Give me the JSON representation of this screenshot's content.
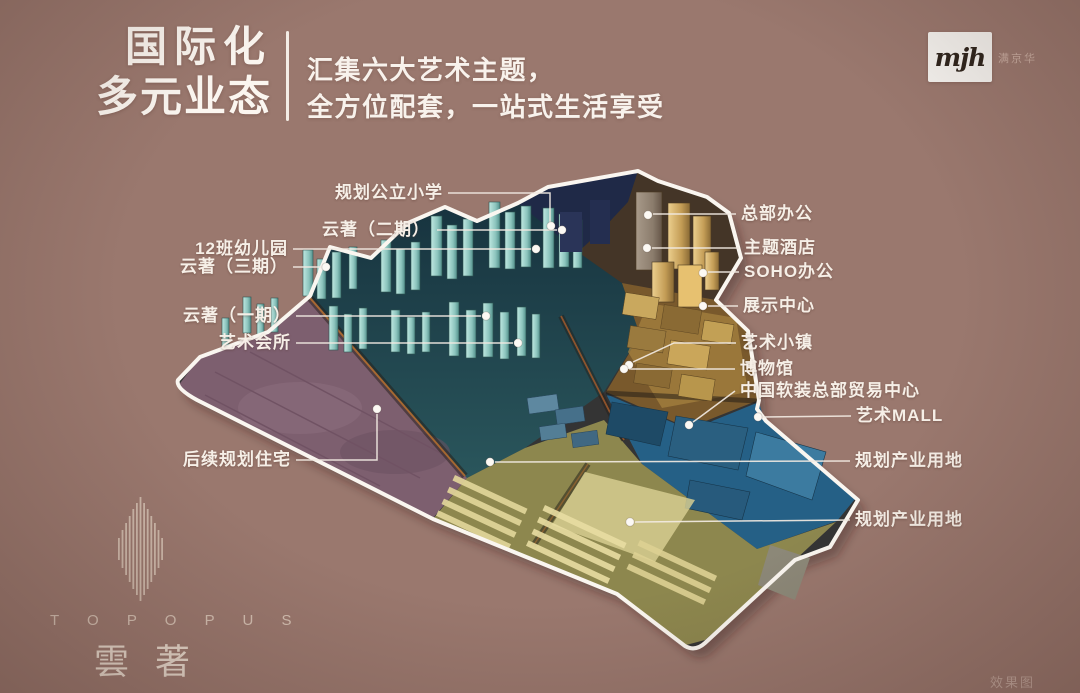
{
  "header": {
    "title_line1": "国际化",
    "title_line2": "多元业态",
    "subtitle_line1": "汇集六大艺术主题，",
    "subtitle_line2": "全方位配套，一站式生活享受",
    "logo_text": "mjh",
    "logo_caption": "满京华"
  },
  "map": {
    "labels": [
      {
        "id": "primary-school",
        "text": "规划公立小学"
      },
      {
        "id": "yunzhu-phase2",
        "text": "云著（二期）"
      },
      {
        "id": "kindergarten",
        "text": "12班幼儿园"
      },
      {
        "id": "yunzhu-phase3",
        "text": "云著（三期）"
      },
      {
        "id": "yunzhu-phase1",
        "text": "云著（一期）"
      },
      {
        "id": "art-club",
        "text": "艺术会所"
      },
      {
        "id": "future-residential",
        "text": "后续规划住宅"
      },
      {
        "id": "hq-office",
        "text": "总部办公"
      },
      {
        "id": "theme-hotel",
        "text": "主题酒店"
      },
      {
        "id": "soho-office",
        "text": "SOHO办公"
      },
      {
        "id": "exhibition-center",
        "text": "展示中心"
      },
      {
        "id": "art-town",
        "text": "艺术小镇"
      },
      {
        "id": "museum",
        "text": "博物馆"
      },
      {
        "id": "soft-deco-center",
        "text": "中国软装总部贸易中心"
      },
      {
        "id": "art-mall",
        "text": "艺术MALL"
      },
      {
        "id": "industrial-1",
        "text": "规划产业用地"
      },
      {
        "id": "industrial-2",
        "text": "规划产业用地"
      }
    ]
  },
  "footer": {
    "brand_en": "T O P O P U S",
    "brand_cn": "雲著",
    "render_note": "效果图"
  },
  "colors": {
    "background": "#9a786e",
    "outline": "#faf6f0",
    "label_text": "#f6efe7",
    "teal_towers": "#a9dcd6",
    "gold_district": "#c9a45c",
    "blue_strip": "#2d6b8d",
    "purple_plot": "#7d5f6f",
    "road_orange": "#b5702f"
  }
}
